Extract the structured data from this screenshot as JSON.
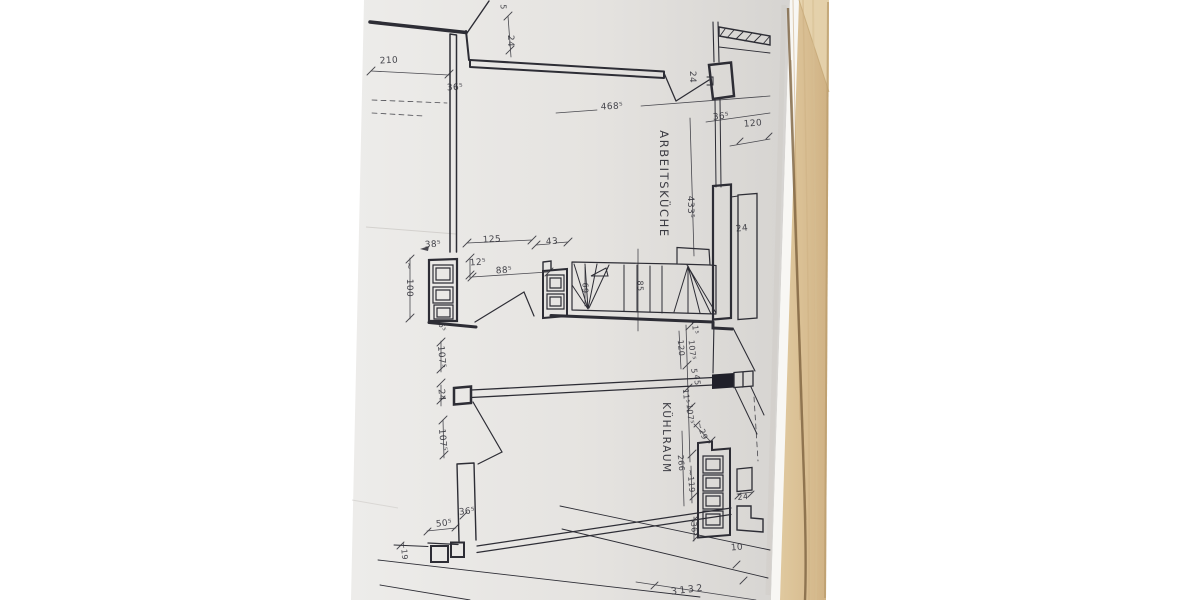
{
  "colors": {
    "canvas": "#ffffff",
    "paper": "#e6e4e1",
    "paper_edge": "#f8f7f4",
    "ink": "#2d2d35",
    "wood": "#d8bf96",
    "wood_grain_dark": "#7c6140",
    "door_marker_fill": "#20202a"
  },
  "plan": {
    "rooms": {
      "kitchen": "ARBEITSKÜCHE",
      "cold_room": "KÜHLRAUM"
    },
    "labels": {
      "t210": "210",
      "t36_tl": "36⁵",
      "t24_top": "24",
      "t5_top": "5",
      "t468": "468⁵",
      "t24_door": "24",
      "t36_tr": "36⁵",
      "t120_edge": "120",
      "t433": "433⁵",
      "t24_right": "24",
      "t38": "38⁵",
      "t125": "125",
      "t43": "43",
      "t12_5": "12⁵",
      "t88": "88⁵",
      "tilde": "~",
      "t100": "100",
      "t69": "69",
      "t85": "85",
      "t6_5": "6⁵",
      "t107_a": "107⁵",
      "t24_pillar": "24",
      "t107_b": "107⁵",
      "t11_a": "11⁵",
      "t120_mid": "120",
      "t107_c": "107⁵",
      "t5_mid": "5",
      "t45": "45",
      "t11_b": "11⁵",
      "t107_d": "107⁵",
      "t29": "~29",
      "t266": "266",
      "t119": "~119",
      "t36_k": "36⁵",
      "t24_k": "24",
      "t50": "50⁵",
      "t36_b": "36⁵",
      "t19": "~19",
      "t10": "10",
      "t3132": "3132"
    }
  }
}
